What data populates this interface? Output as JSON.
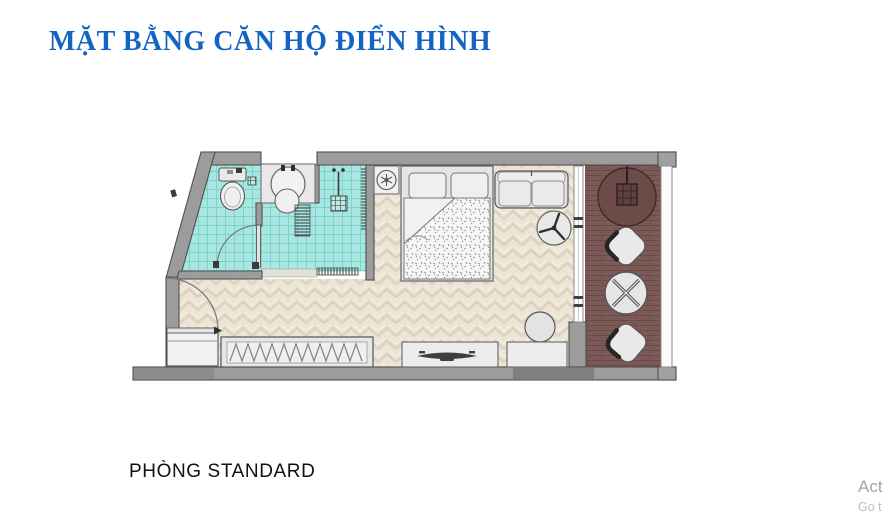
{
  "title": {
    "text": "MẶT BẰNG CĂN HỘ ĐIỂN HÌNH",
    "color": "#1464c4"
  },
  "plan_label": {
    "text": "PHÒNG STANDARD"
  },
  "watermark": {
    "line1": "Act",
    "line2": "Go t"
  },
  "colors": {
    "background": "#ffffff",
    "title_blue": "#1464c4",
    "label_text": "#111111",
    "bathroom_tile": "#a7e6e1",
    "tile_grid": "#7fd2cb",
    "wood_floor": "#ece4d4",
    "wood_grain_dark": "#dcd2bf",
    "wood_grain_light": "#f5efe2",
    "balcony_floor": "#7c5a57",
    "balcony_plank_line": "#6a4947",
    "hanging_chair_fill": "#6d4b49",
    "wall_gray": "#9c9c9c",
    "wall_dark_segment": "#848484",
    "wall_outline": "#4f4f4f",
    "furniture_fill": "#e9e9e9",
    "furniture_outline": "#555555",
    "glass_white": "#fdfdfd",
    "watermark_primary": "#a3a3a3",
    "watermark_secondary": "#bdbdbd"
  }
}
